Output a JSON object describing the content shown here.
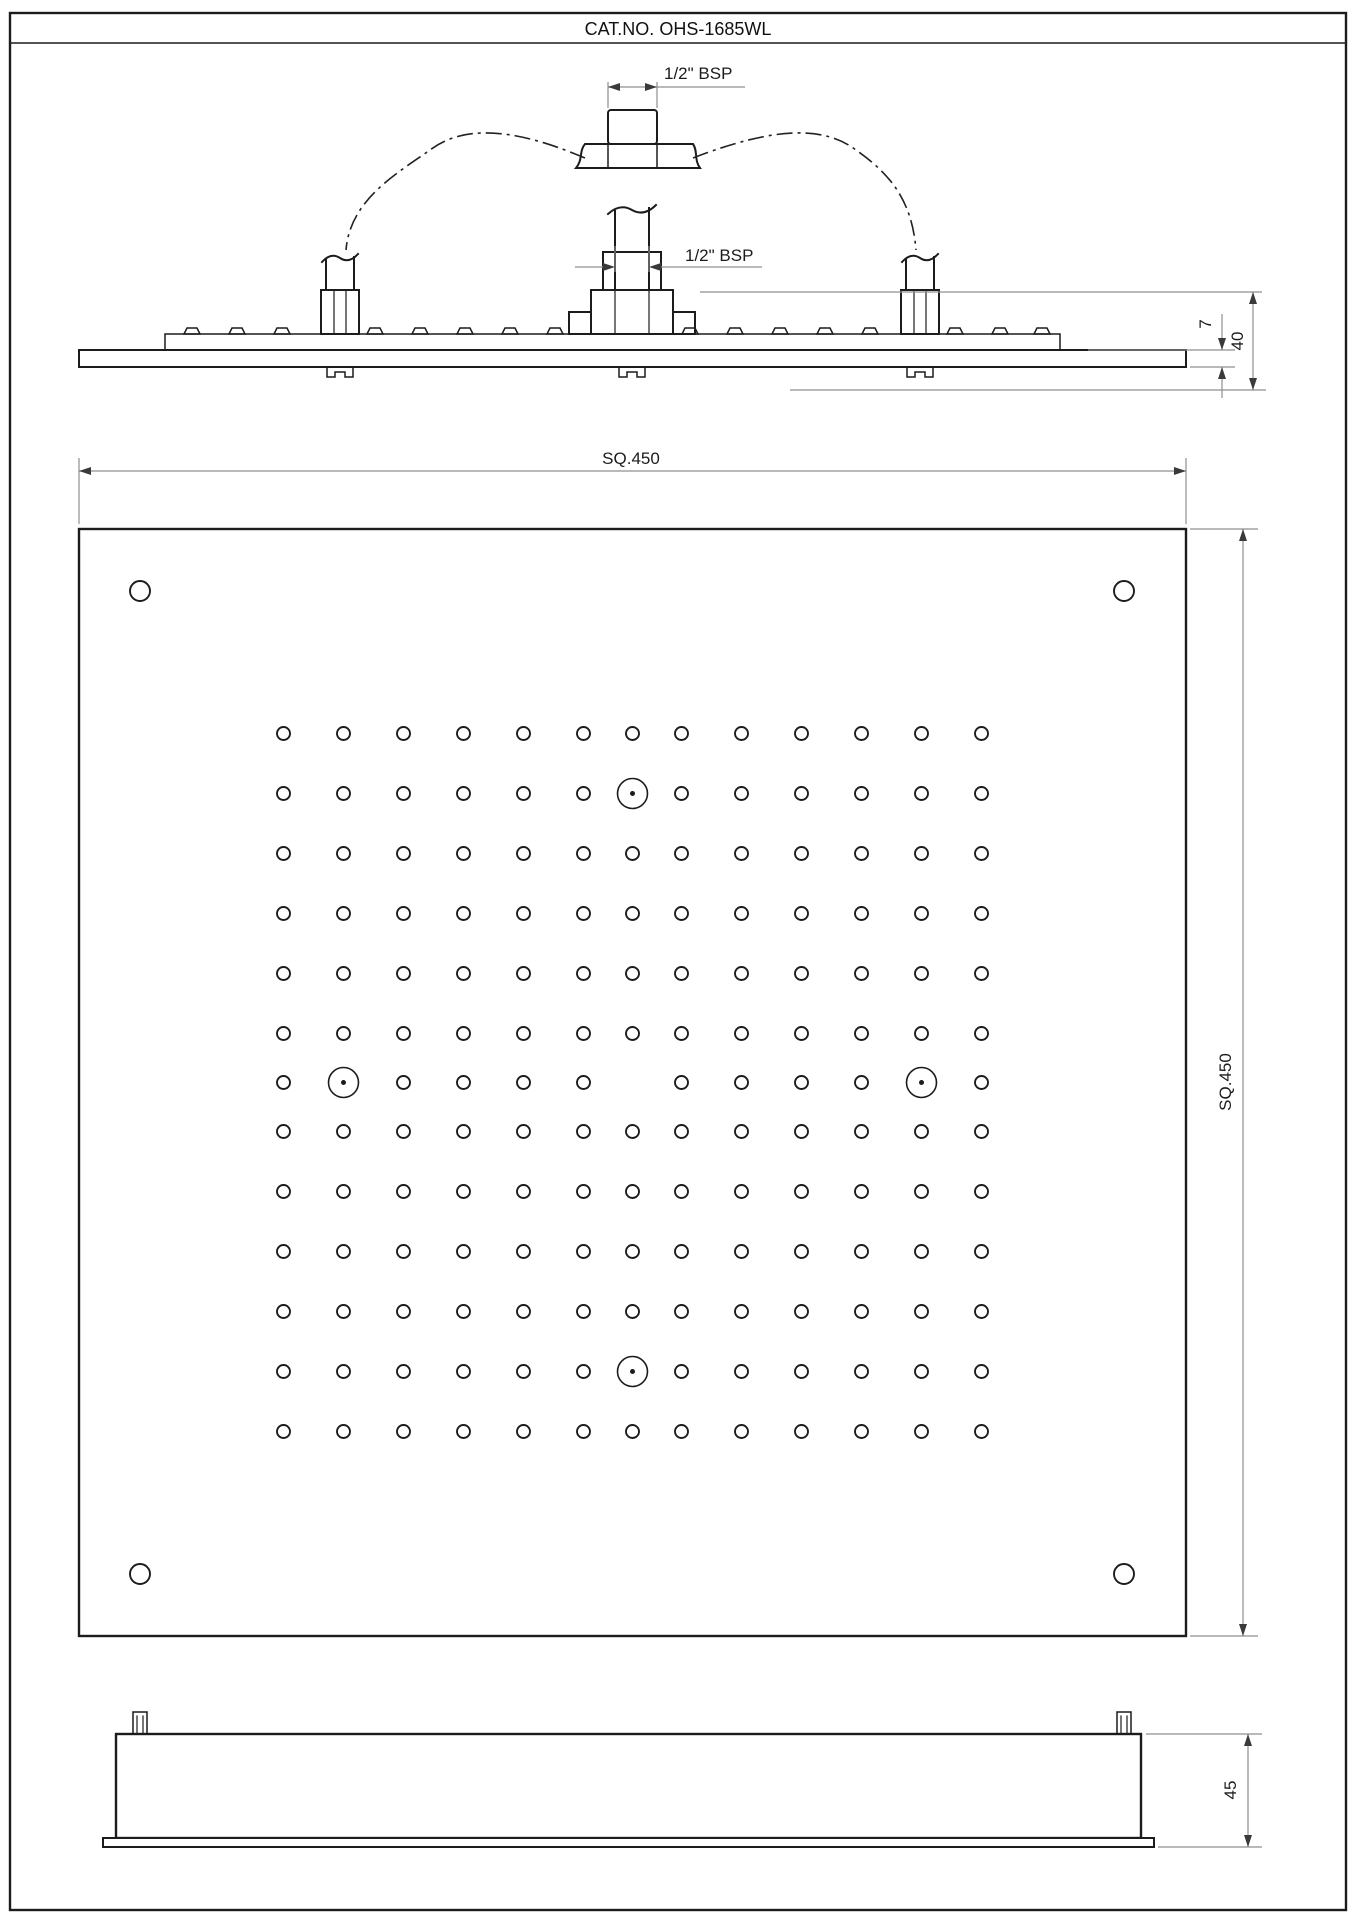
{
  "title": "CAT.NO. OHS-1685WL",
  "labels": {
    "bsp_top": "1/2\" BSP",
    "bsp_mid": "1/2\" BSP"
  },
  "dimensions": {
    "width_top": "SQ.450",
    "height_right": "SQ.450",
    "plate_thickness": "7",
    "assembly_height": "40",
    "housing_depth": "45"
  },
  "colors": {
    "line": "#1c1c1c",
    "dimension": "#8f8f8f",
    "background": "#ffffff"
  },
  "front_view": {
    "grid": {
      "count": 13,
      "offsets": [
        -349,
        -289,
        -229,
        -169,
        -109,
        -49,
        0,
        49,
        109,
        169,
        229,
        289,
        349
      ],
      "center_x": 632.5,
      "center_y": 1082.5,
      "hole_radius": 6.5,
      "skip": [
        [
          0,
          0
        ],
        [
          0,
          -289
        ],
        [
          -289,
          0
        ],
        [
          289,
          0
        ],
        [
          0,
          289
        ]
      ]
    },
    "inlet_ports": {
      "radius": 15,
      "dot_radius": 2.5,
      "positions": [
        [
          0,
          -289
        ],
        [
          -289,
          0
        ],
        [
          289,
          0
        ],
        [
          0,
          289
        ]
      ]
    },
    "corner_screws": {
      "radius": 10,
      "positions": [
        [
          140,
          591
        ],
        [
          1124,
          591
        ],
        [
          140,
          1574
        ],
        [
          1124,
          1574
        ]
      ]
    }
  }
}
